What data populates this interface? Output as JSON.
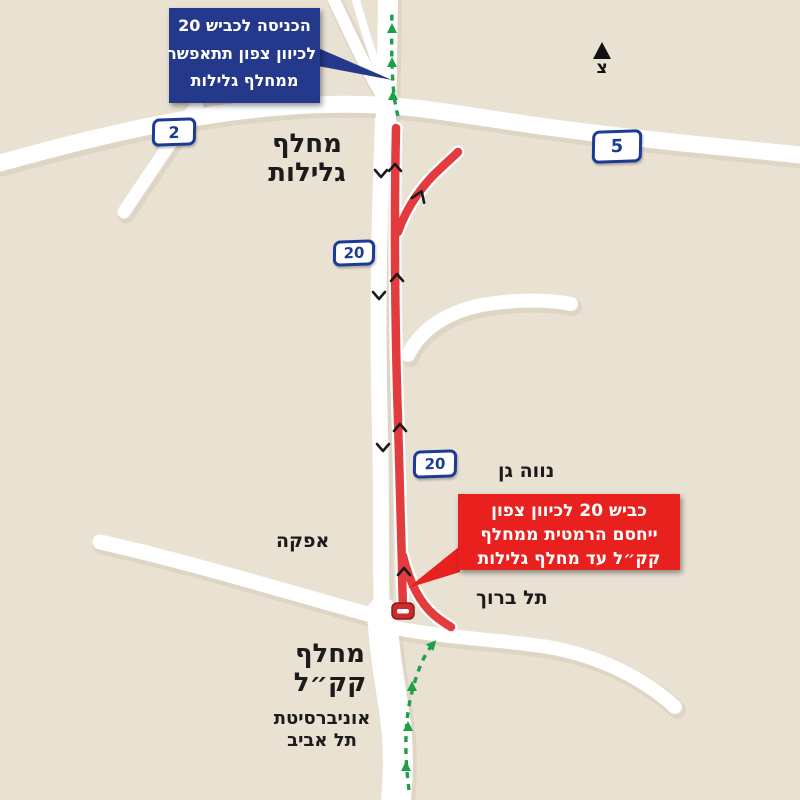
{
  "map": {
    "colors": {
      "background": "#e9e1d2",
      "road": "#ffffff",
      "road_shadow": "#d6ccba",
      "closed_road_red": "#e23c3f",
      "callout_blue": "#24398c",
      "callout_red": "#e8201e",
      "shield_blue": "#1c3b97",
      "open_route_green": "#1ea04b",
      "chevron_black": "#1a1a1a"
    },
    "north_indicator": {
      "letter": "צ"
    },
    "callouts": {
      "blue": {
        "lines": [
          "הכניסה לכביש 20",
          "לכיוון צפון תתאפשר",
          "ממחלף גלילות"
        ]
      },
      "red": {
        "lines": [
          "כביש 20 לכיוון צפון",
          "ייחסם הרמטית ממחלף",
          "קק״ל עד מחלף גלילות"
        ]
      }
    },
    "shields": [
      {
        "number": "2"
      },
      {
        "number": "5"
      },
      {
        "number": "20"
      },
      {
        "number": "20"
      }
    ],
    "labels": {
      "glilot_line1": "מחלף",
      "glilot_line2": "גלילות",
      "kkl_line1": "מחלף",
      "kkl_line2": "קק״ל",
      "neve_gan": "נווה גן",
      "afeka": "אפקה",
      "tel_baruch": "תל ברוך",
      "university_line1": "אוניברסיטת",
      "university_line2": "תל אביב"
    }
  }
}
